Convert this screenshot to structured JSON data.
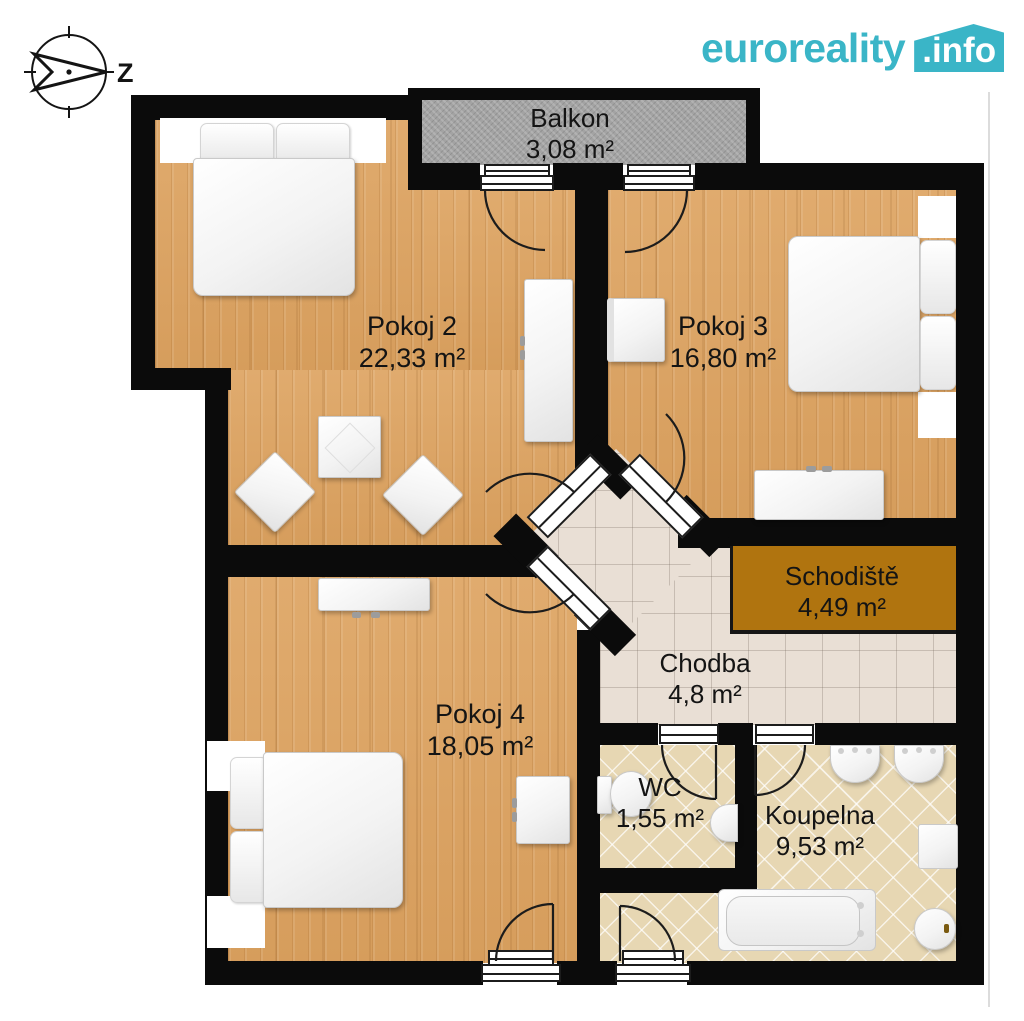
{
  "header": {
    "logo": {
      "name": "euroreality",
      "tld": ".info"
    },
    "compass_label": "Z"
  },
  "rooms": {
    "balkon": {
      "name": "Balkon",
      "area": "3,08 m²"
    },
    "pokoj2": {
      "name": "Pokoj 2",
      "area": "22,33 m²"
    },
    "pokoj3": {
      "name": "Pokoj 3",
      "area": "16,80 m²"
    },
    "pokoj4": {
      "name": "Pokoj 4",
      "area": "18,05 m²"
    },
    "schodiste": {
      "name": "Schodiště",
      "area": "4,49 m²"
    },
    "chodba": {
      "name": "Chodba",
      "area": "4,8 m²"
    },
    "wc": {
      "name": "WC",
      "area": "1,55 m²"
    },
    "koupelna": {
      "name": "Koupelna",
      "area": "9,53 m²"
    }
  },
  "colors": {
    "accent": "#3ab5c7",
    "wall": "#0b0b0b",
    "wood_floor": "#dca76a",
    "hall_tile": "#e9dfd5",
    "bath_tile": "#e7d7b3",
    "balcony_concrete": "#a3a3a3",
    "stairs_brown": "#b0740f"
  }
}
